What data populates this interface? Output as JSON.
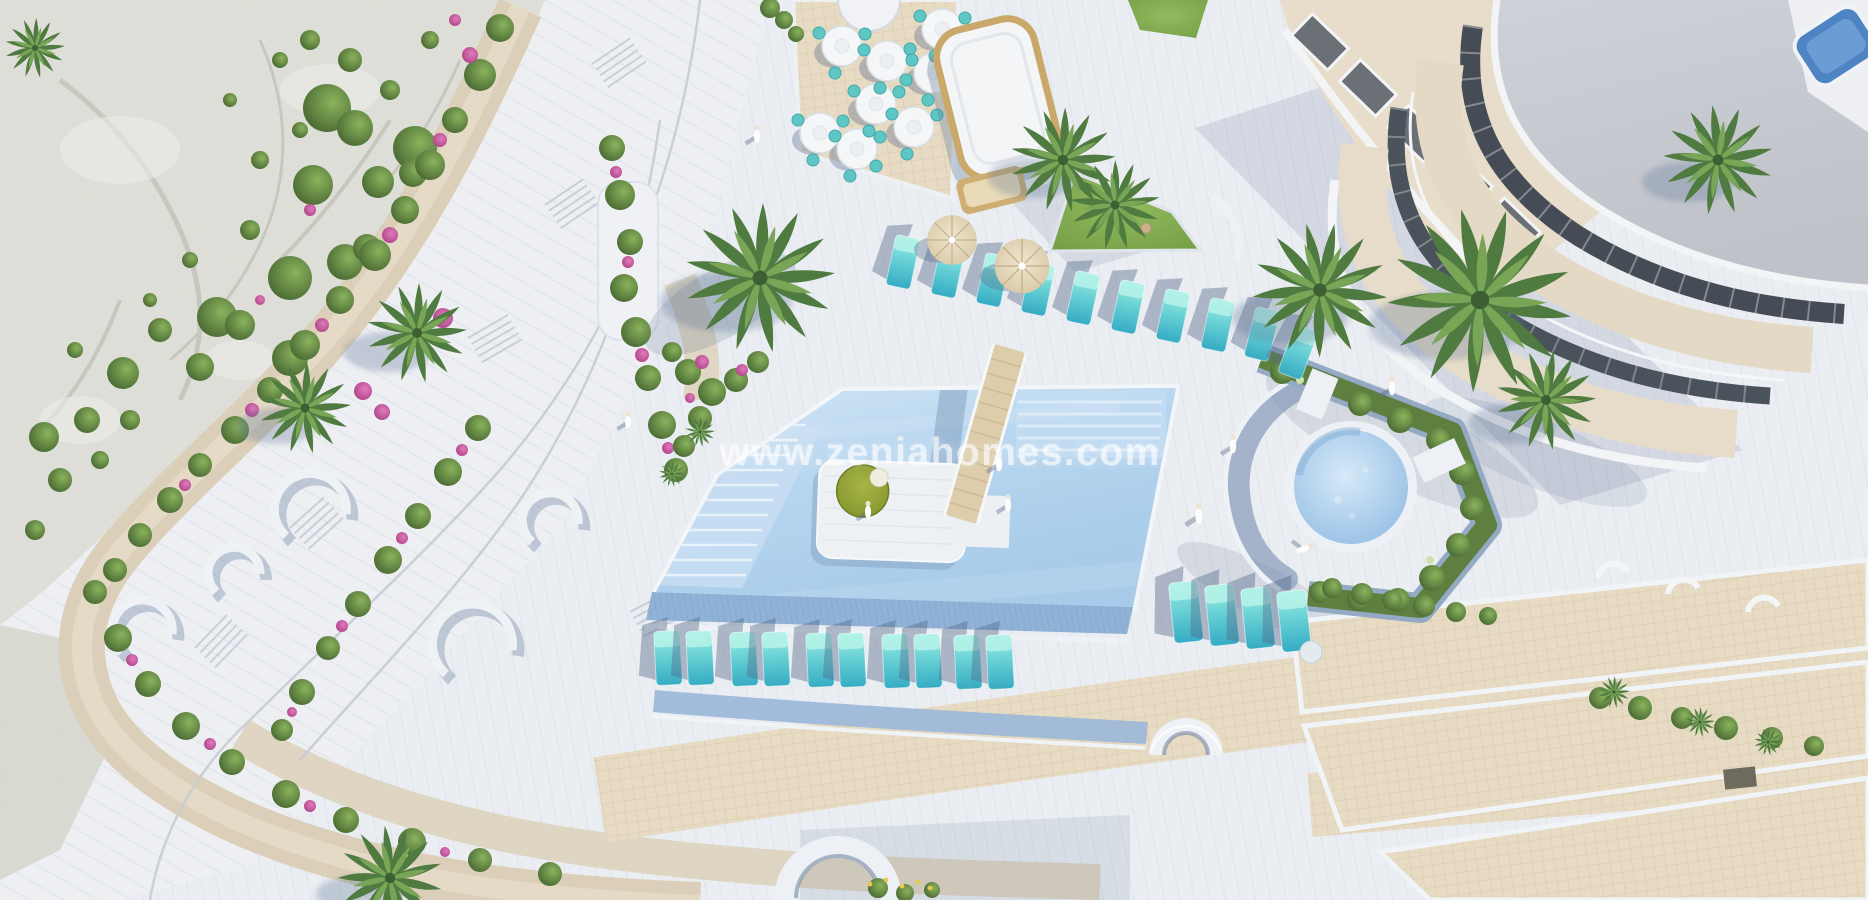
{
  "watermark": {
    "text": "www.zeniahomes.com"
  },
  "scene": {
    "type": "aerial-3d-render",
    "subject": "Aerial view of a resort pool deck with sun terraces, restaurant area, rocky hillside and curved apartment building",
    "counts": {
      "bottom_row_loungers": 10,
      "top_row_loungers": 10,
      "right_group_loungers": 4,
      "restaurant_tables": 8,
      "parasols": 2,
      "pools": 2
    }
  },
  "colors": {
    "deck": "#eaedf1",
    "deckLine": "#d8dde4",
    "rock": "#dedfd8",
    "road": "#dccfb9",
    "tileBeige": "#e7dbc4",
    "tileLine": "#d8c9ac",
    "poolLight": "#d3e6f6",
    "poolDeep": "#a7cbe9",
    "channel": "#8fb2d6",
    "teal": "#5fcbd2",
    "tealDark": "#36abc4",
    "slate": "#54688a",
    "greenDark": "#44672f",
    "greenMid": "#6b9246",
    "palmDark": "#4f7a40",
    "palmLight": "#79a557",
    "pink": "#c74f9b",
    "tan": "#c9a86a",
    "parasol": "#ded0b2",
    "roof": "#c7cad0",
    "windowDark": "#454c55",
    "terraceBeige": "#e4d9c5",
    "roofPoolBlue": "#4e83c4",
    "lawn": "#7aa348",
    "olive": "#8a9b2e"
  }
}
